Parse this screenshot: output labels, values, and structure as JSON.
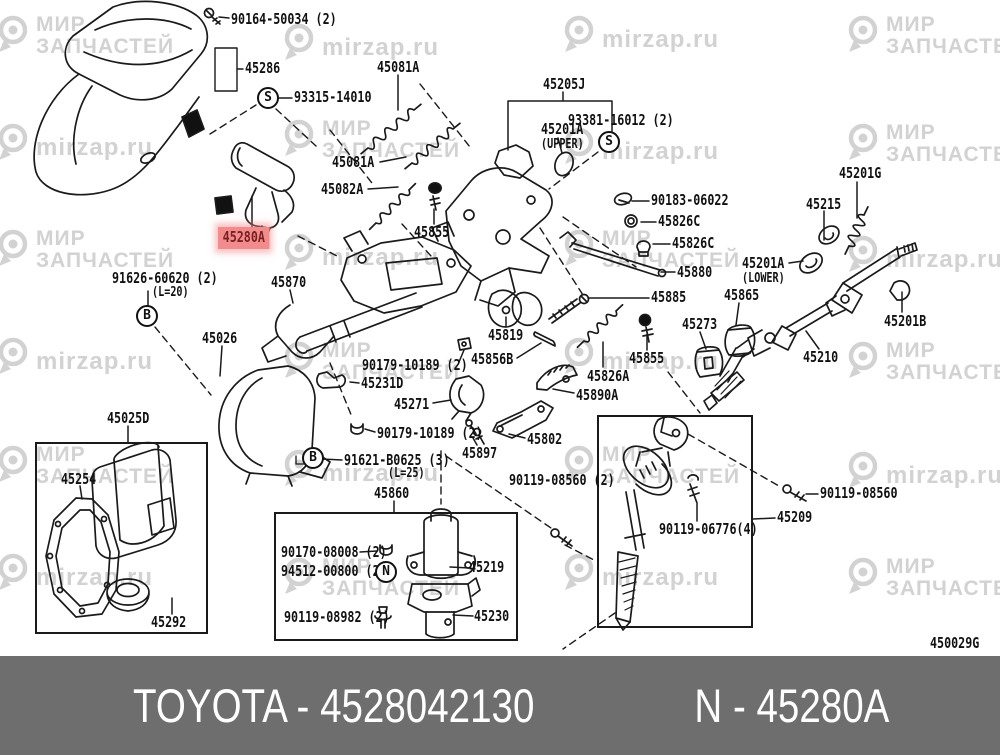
{
  "watermark": {
    "brand_line1": "МИР",
    "brand_line2": "ЗАПЧАСТЕЙ",
    "site": "mirzap.ru",
    "tiles": [
      {
        "x": -4,
        "y": 14,
        "type": "a"
      },
      {
        "x": 282,
        "y": 22,
        "type": "b"
      },
      {
        "x": 562,
        "y": 14,
        "type": "b"
      },
      {
        "x": 846,
        "y": 14,
        "type": "a"
      },
      {
        "x": -4,
        "y": 122,
        "type": "b"
      },
      {
        "x": 282,
        "y": 118,
        "type": "a"
      },
      {
        "x": 562,
        "y": 126,
        "type": "b"
      },
      {
        "x": 846,
        "y": 122,
        "type": "a"
      },
      {
        "x": -4,
        "y": 228,
        "type": "a"
      },
      {
        "x": 282,
        "y": 232,
        "type": "b"
      },
      {
        "x": 562,
        "y": 228,
        "type": "a"
      },
      {
        "x": 846,
        "y": 234,
        "type": "b"
      },
      {
        "x": -4,
        "y": 336,
        "type": "b"
      },
      {
        "x": 282,
        "y": 340,
        "type": "a"
      },
      {
        "x": 562,
        "y": 336,
        "type": "b"
      },
      {
        "x": 846,
        "y": 340,
        "type": "a"
      },
      {
        "x": -4,
        "y": 444,
        "type": "a"
      },
      {
        "x": 282,
        "y": 448,
        "type": "b"
      },
      {
        "x": 562,
        "y": 444,
        "type": "a"
      },
      {
        "x": 846,
        "y": 450,
        "type": "b"
      },
      {
        "x": -4,
        "y": 552,
        "type": "b"
      },
      {
        "x": 282,
        "y": 556,
        "type": "a"
      },
      {
        "x": 562,
        "y": 552,
        "type": "b"
      },
      {
        "x": 846,
        "y": 556,
        "type": "a"
      },
      {
        "x": -4,
        "y": 662,
        "type": "a"
      },
      {
        "x": 282,
        "y": 668,
        "type": "b"
      },
      {
        "x": 562,
        "y": 662,
        "type": "a"
      },
      {
        "x": 846,
        "y": 668,
        "type": "b"
      }
    ]
  },
  "highlight": {
    "color": "#f28c8c",
    "text_color": "#7a2020"
  },
  "labels": [
    {
      "text": "90164-50034 (2)",
      "x": 231,
      "y": 12
    },
    {
      "text": "45286",
      "x": 245,
      "y": 61
    },
    {
      "text": "93315-14010",
      "x": 294,
      "y": 90
    },
    {
      "text": "45081A",
      "x": 377,
      "y": 60
    },
    {
      "text": "45205J",
      "x": 543,
      "y": 77
    },
    {
      "text": "93381-16012 (2)",
      "x": 568,
      "y": 113
    },
    {
      "text": "45201A",
      "x": 541,
      "y": 122
    },
    {
      "text": "(UPPER)",
      "x": 541,
      "y": 138,
      "cls": "sub"
    },
    {
      "text": "45081A",
      "x": 332,
      "y": 155
    },
    {
      "text": "45082A",
      "x": 321,
      "y": 182
    },
    {
      "text": "45855",
      "x": 414,
      "y": 225
    },
    {
      "text": "45280A",
      "x": 218,
      "y": 227,
      "cls": "hl"
    },
    {
      "text": "90183-06022",
      "x": 651,
      "y": 193
    },
    {
      "text": "45826C",
      "x": 658,
      "y": 214
    },
    {
      "text": "45826C",
      "x": 672,
      "y": 236
    },
    {
      "text": "45201G",
      "x": 839,
      "y": 166
    },
    {
      "text": "45215",
      "x": 806,
      "y": 197
    },
    {
      "text": "45201A",
      "x": 742,
      "y": 256
    },
    {
      "text": "(LOWER)",
      "x": 742,
      "y": 272,
      "cls": "sub"
    },
    {
      "text": "45880",
      "x": 677,
      "y": 265
    },
    {
      "text": "45885",
      "x": 651,
      "y": 290
    },
    {
      "text": "45865",
      "x": 724,
      "y": 288
    },
    {
      "text": "91626-60620 (2)",
      "x": 112,
      "y": 271
    },
    {
      "text": "(L=20)",
      "x": 152,
      "y": 286,
      "cls": "sub"
    },
    {
      "text": "45870",
      "x": 271,
      "y": 275
    },
    {
      "text": "45273",
      "x": 682,
      "y": 317
    },
    {
      "text": "45201B",
      "x": 884,
      "y": 314
    },
    {
      "text": "45026",
      "x": 202,
      "y": 331
    },
    {
      "text": "45819",
      "x": 488,
      "y": 328
    },
    {
      "text": "45855",
      "x": 629,
      "y": 351
    },
    {
      "text": "45210",
      "x": 803,
      "y": 350
    },
    {
      "text": "45856B",
      "x": 471,
      "y": 352
    },
    {
      "text": "90179-10189 (2)",
      "x": 362,
      "y": 358
    },
    {
      "text": "45231D",
      "x": 361,
      "y": 376
    },
    {
      "text": "45826A",
      "x": 587,
      "y": 369
    },
    {
      "text": "45890A",
      "x": 576,
      "y": 388
    },
    {
      "text": "45271",
      "x": 394,
      "y": 397
    },
    {
      "text": "45025D",
      "x": 107,
      "y": 411
    },
    {
      "text": "90179-10189 (2)",
      "x": 377,
      "y": 426
    },
    {
      "text": "45802",
      "x": 527,
      "y": 432
    },
    {
      "text": "45897",
      "x": 462,
      "y": 446
    },
    {
      "text": "91621-B0625 (3)",
      "x": 344,
      "y": 453
    },
    {
      "text": "(L=25)",
      "x": 388,
      "y": 467,
      "cls": "sub"
    },
    {
      "text": "90119-08560 (2)",
      "x": 509,
      "y": 473
    },
    {
      "text": "45860",
      "x": 374,
      "y": 486
    },
    {
      "text": "45254",
      "x": 61,
      "y": 472
    },
    {
      "text": "90119-08560",
      "x": 820,
      "y": 486
    },
    {
      "text": "45209",
      "x": 777,
      "y": 510
    },
    {
      "text": "90119-06776(4)",
      "x": 659,
      "y": 522
    },
    {
      "text": "90170-08008 (2)",
      "x": 281,
      "y": 545
    },
    {
      "text": "94512-00800 (2)",
      "x": 281,
      "y": 564
    },
    {
      "text": "45219",
      "x": 469,
      "y": 560
    },
    {
      "text": "90119-08982 (2)",
      "x": 284,
      "y": 610
    },
    {
      "text": "45230",
      "x": 474,
      "y": 609
    },
    {
      "text": "45292",
      "x": 151,
      "y": 615
    },
    {
      "text": "450029G",
      "x": 930,
      "y": 636
    }
  ],
  "circles": [
    {
      "letter": "S",
      "x": 268,
      "y": 98
    },
    {
      "letter": "S",
      "x": 609,
      "y": 142
    },
    {
      "letter": "B",
      "x": 147,
      "y": 316
    },
    {
      "letter": "B",
      "x": 313,
      "y": 458
    },
    {
      "letter": "N",
      "x": 386,
      "y": 572
    }
  ],
  "footer": {
    "left": "TOYOTA - 4528042130",
    "right": "N - 45280A",
    "bg": "#6e6e6e"
  }
}
